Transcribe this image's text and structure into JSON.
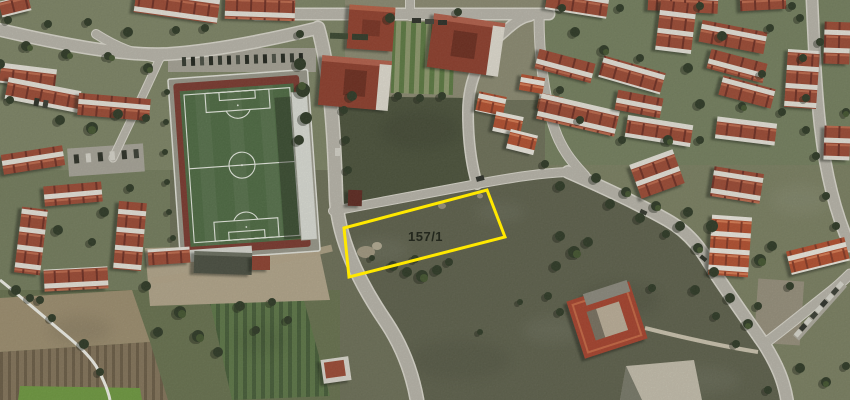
{
  "map": {
    "type": "aerial-imagery-with-cadastral-overlay",
    "annotation": {
      "parcel_label": "157/1",
      "parcel_outline_color": "#ffe800",
      "parcel_label_color": "#23271d",
      "parcel_polygon_points": "344,228 487,190 505,237 349,277",
      "parcel_label_x": "408",
      "parcel_label_y": "241"
    },
    "palette": {
      "terrain": "#6d7058",
      "road": "#bab7ac",
      "road_edge": "#dcd9ce",
      "pitch_green": "#4e6b43",
      "track_red": "#7b392e",
      "roof_red": "#9d4a34",
      "roof_bright": "#b5502f",
      "tree_dark": "#2e3a26",
      "dirt": "#b3a58a"
    }
  }
}
